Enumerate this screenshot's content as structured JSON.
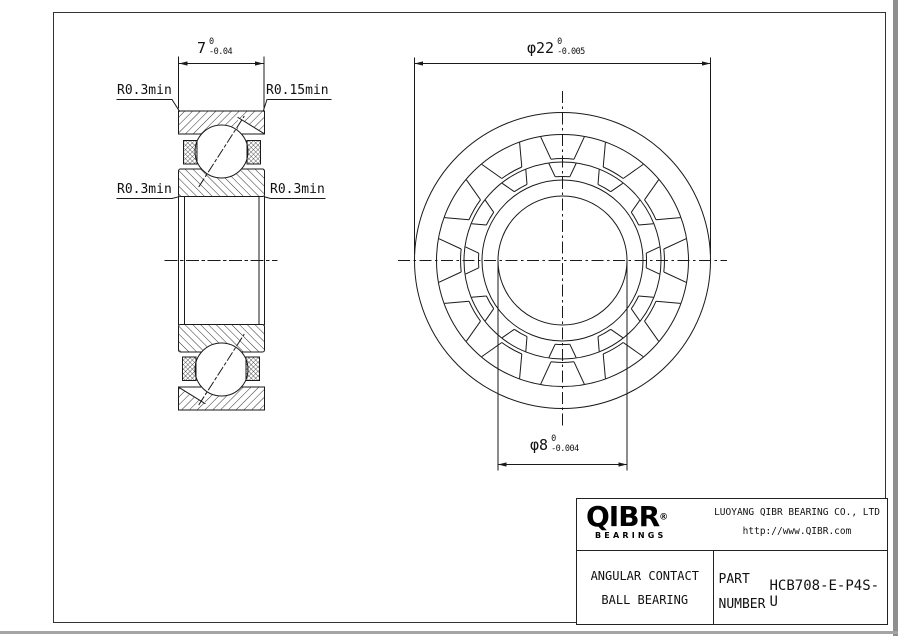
{
  "section_view": {
    "width_dim": {
      "value": "7",
      "tol_upper": "0",
      "tol_lower": "-0.04"
    },
    "fillet_labels": {
      "top_left": "R0.3min",
      "top_right": "R0.15min",
      "mid_left": "R0.3min",
      "mid_right": "R0.3min"
    }
  },
  "front_view": {
    "od_dim": {
      "value": "φ22",
      "tol_upper": "0",
      "tol_lower": "-0.005"
    },
    "bore_dim": {
      "value": "φ8",
      "tol_upper": "0",
      "tol_lower": "-0.004"
    }
  },
  "title_block": {
    "logo_text": "QIBR",
    "logo_reg": "®",
    "logo_sub": "BEARINGS",
    "company": "LUOYANG QIBR BEARING CO., LTD",
    "website": "http://www.QIBR.com",
    "product_type_line1": "ANGULAR CONTACT",
    "product_type_line2": "BALL BEARING",
    "part_label_line1": "PART",
    "part_label_line2": "NUMBER",
    "part_number": "HCB708-E-P4S-U"
  },
  "colors": {
    "line": "#1a1a1a",
    "background": "#ffffff"
  }
}
